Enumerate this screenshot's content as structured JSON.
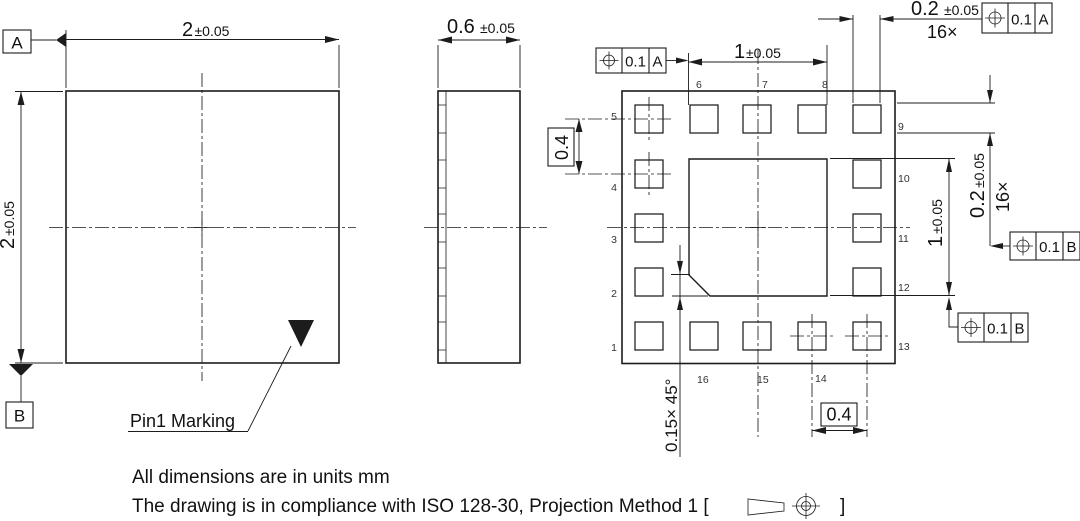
{
  "front_view": {
    "dim_width_value": "2",
    "dim_width_tol": "±0.05",
    "dim_height_value": "2",
    "dim_height_tol": "±0.05",
    "datum_a": "A",
    "datum_b": "B",
    "pin1_label": "Pin1 Marking"
  },
  "side_view": {
    "dim_value": "0.6",
    "dim_tol": "±0.05"
  },
  "bottom_view": {
    "dim_top_value": "1",
    "dim_top_tol": "±0.05",
    "dim_pad_w_value": "0.2",
    "dim_pad_w_tol": "±0.05",
    "pad_count_top": "16×",
    "dim_pad_h_value": "0.2",
    "dim_pad_h_tol": "±0.05",
    "pad_count_right": "16×",
    "dim_epad_value": "1",
    "dim_epad_tol": "±0.05",
    "pitch_left": "0.4",
    "pitch_bottom": "0.4",
    "chamfer": "0.15× 45°",
    "fcf_top_left": {
      "tolerance": "0.1",
      "datum": "A"
    },
    "fcf_top_right": {
      "tolerance": "0.1",
      "datum": "A"
    },
    "fcf_right": {
      "tolerance": "0.1",
      "datum": "B"
    },
    "fcf_bottom": {
      "tolerance": "0.1",
      "datum": "B"
    },
    "pins": {
      "left": [
        "5",
        "4",
        "3",
        "2",
        "1"
      ],
      "top": [
        "6",
        "7",
        "8"
      ],
      "right": [
        "9",
        "10",
        "11",
        "12",
        "13"
      ],
      "bottom": [
        "16",
        "15",
        "14"
      ]
    }
  },
  "notes": {
    "line1": "All dimensions are in units mm",
    "line2_prefix": "The drawing is in compliance with ISO 128-30, Projection Method 1 [",
    "line2_suffix": "]"
  },
  "colors": {
    "line": "#1c1c1c",
    "background": "#ffffff"
  }
}
